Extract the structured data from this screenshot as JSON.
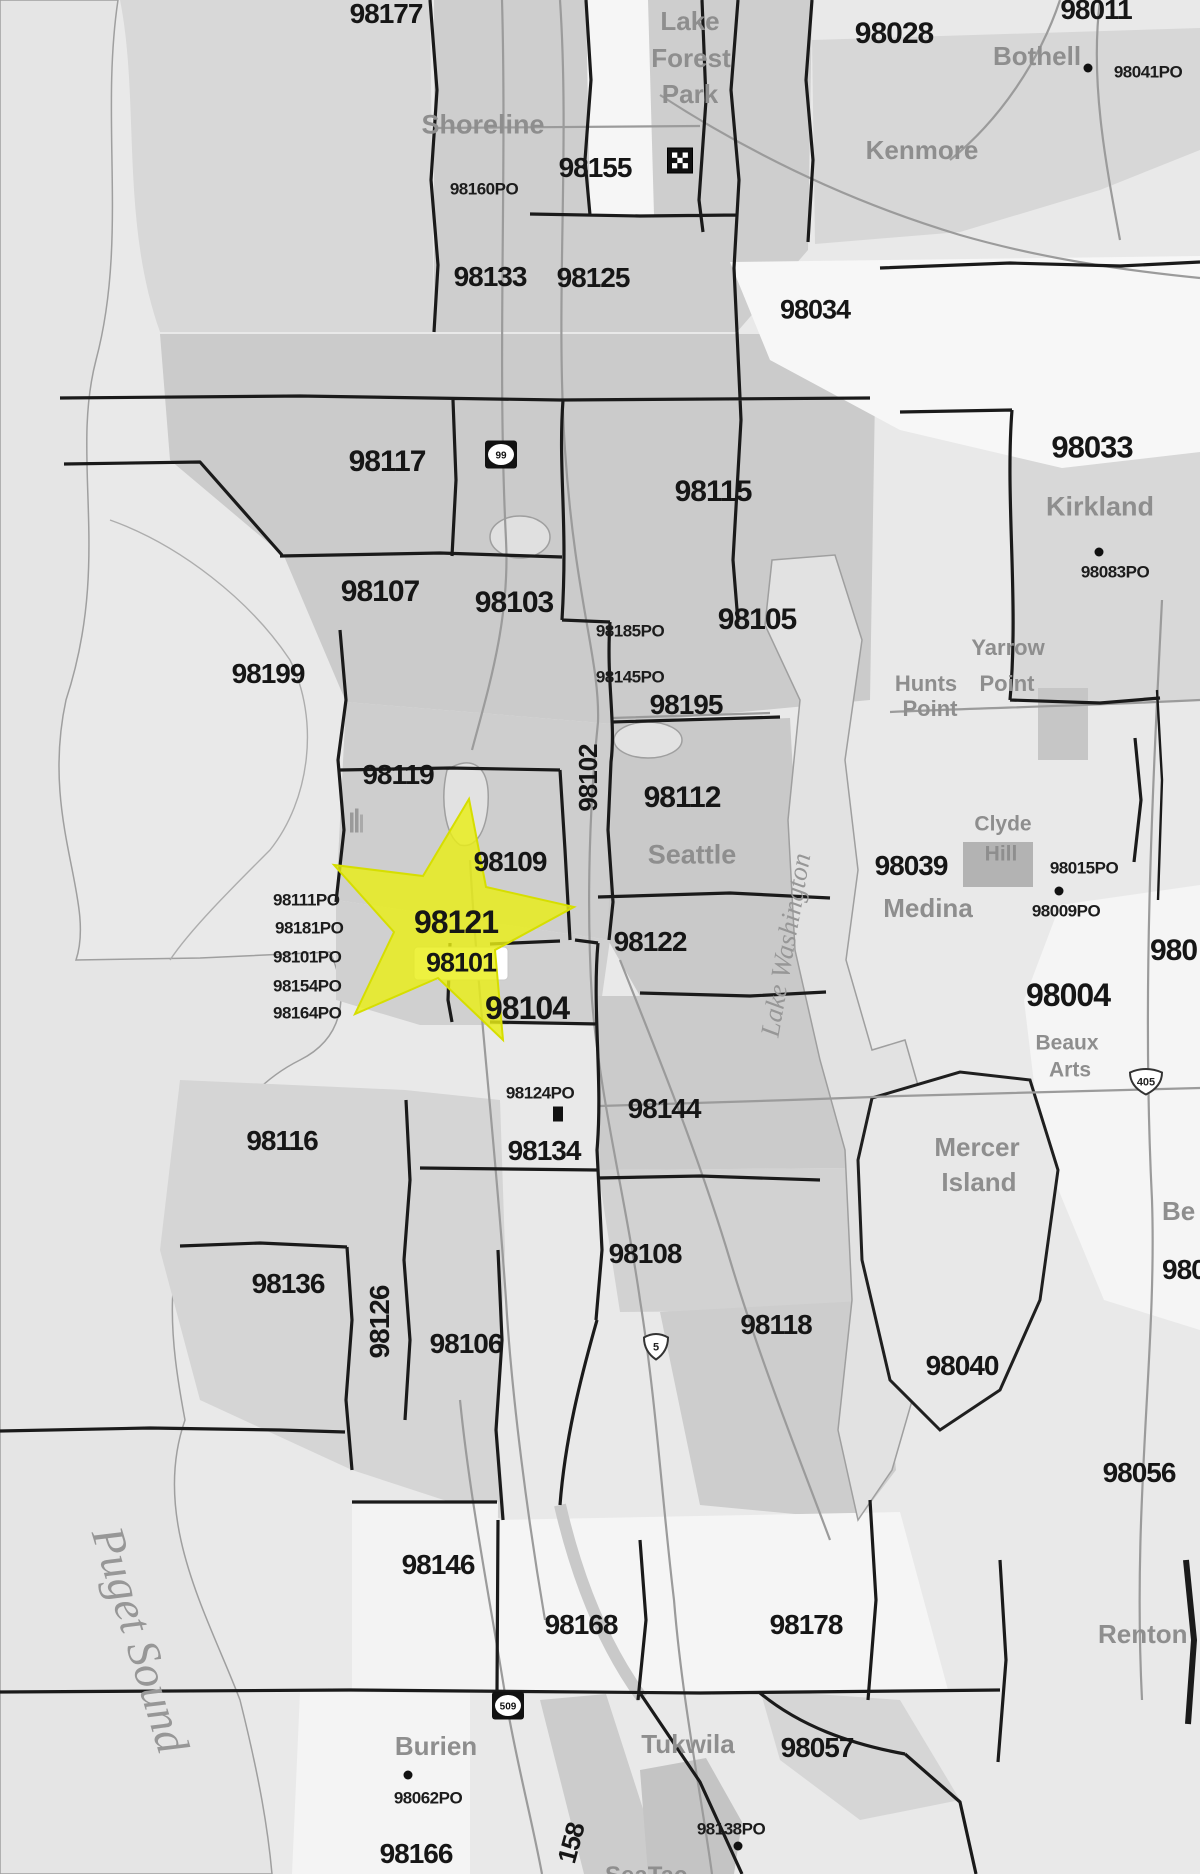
{
  "map": {
    "description": "Seattle area ZIP code map with highlighted star over downtown Seattle",
    "colors": {
      "land": "#e9e9e9",
      "land_dark": "#cbcbcb",
      "water": "#e4e4e4",
      "white_region": "#f6f6f6",
      "boundary": "#1a1a1a",
      "road": "#9b9b9b",
      "zip_text": "#161616",
      "city_text": "#8e8e8e",
      "water_text": "#979797",
      "highlight_star": "#e9ee16"
    },
    "highlight_star": {
      "cx": 447,
      "cy": 925,
      "note": "yellow star over 98121/98101"
    },
    "labels": [
      {
        "kind": "zip",
        "text": "98177",
        "x": 386,
        "y": 14,
        "size": 28
      },
      {
        "kind": "zip",
        "text": "98011",
        "x": 1096,
        "y": 10,
        "size": 28
      },
      {
        "kind": "zip",
        "text": "98028",
        "x": 894,
        "y": 34,
        "size": 30
      },
      {
        "kind": "zip",
        "text": "98155",
        "x": 595,
        "y": 168,
        "size": 28
      },
      {
        "kind": "zip",
        "text": "98133",
        "x": 490,
        "y": 277,
        "size": 28
      },
      {
        "kind": "zip",
        "text": "98125",
        "x": 593,
        "y": 278,
        "size": 28
      },
      {
        "kind": "zip",
        "text": "98034",
        "x": 815,
        "y": 310,
        "size": 27
      },
      {
        "kind": "zip",
        "text": "98117",
        "x": 387,
        "y": 462,
        "size": 30
      },
      {
        "kind": "zip",
        "text": "98115",
        "x": 713,
        "y": 492,
        "size": 30
      },
      {
        "kind": "zip",
        "text": "98033",
        "x": 1092,
        "y": 447,
        "size": 31
      },
      {
        "kind": "zip",
        "text": "98107",
        "x": 380,
        "y": 592,
        "size": 30
      },
      {
        "kind": "zip",
        "text": "98103",
        "x": 514,
        "y": 603,
        "size": 30
      },
      {
        "kind": "zip",
        "text": "98105",
        "x": 757,
        "y": 620,
        "size": 30
      },
      {
        "kind": "zip",
        "text": "98195",
        "x": 686,
        "y": 705,
        "size": 28
      },
      {
        "kind": "zip",
        "text": "98199",
        "x": 268,
        "y": 674,
        "size": 28
      },
      {
        "kind": "zip",
        "text": "98119",
        "x": 398,
        "y": 775,
        "size": 28
      },
      {
        "kind": "zip",
        "text": "98102",
        "x": 588,
        "y": 778,
        "size": 26,
        "rot": -90
      },
      {
        "kind": "zip",
        "text": "98112",
        "x": 682,
        "y": 798,
        "size": 30
      },
      {
        "kind": "zip",
        "text": "98109",
        "x": 510,
        "y": 862,
        "size": 28
      },
      {
        "kind": "zip",
        "text": "98121",
        "x": 456,
        "y": 922,
        "size": 32
      },
      {
        "kind": "zip",
        "text": "98101",
        "x": 461,
        "y": 963,
        "size": 27
      },
      {
        "kind": "zip",
        "text": "98122",
        "x": 650,
        "y": 942,
        "size": 28
      },
      {
        "kind": "zip",
        "text": "98104",
        "x": 527,
        "y": 1008,
        "size": 32
      },
      {
        "kind": "zip",
        "text": "98039",
        "x": 911,
        "y": 866,
        "size": 28
      },
      {
        "kind": "zip",
        "text": "98004",
        "x": 1068,
        "y": 995,
        "size": 32
      },
      {
        "kind": "zip",
        "text": "98144",
        "x": 664,
        "y": 1109,
        "size": 28
      },
      {
        "kind": "zip",
        "text": "98134",
        "x": 544,
        "y": 1151,
        "size": 28
      },
      {
        "kind": "zip",
        "text": "98116",
        "x": 282,
        "y": 1141,
        "size": 28
      },
      {
        "kind": "zip",
        "text": "98136",
        "x": 288,
        "y": 1284,
        "size": 28
      },
      {
        "kind": "zip",
        "text": "98126",
        "x": 380,
        "y": 1322,
        "size": 28,
        "rot": -90
      },
      {
        "kind": "zip",
        "text": "98106",
        "x": 466,
        "y": 1344,
        "size": 28
      },
      {
        "kind": "zip",
        "text": "98108",
        "x": 645,
        "y": 1254,
        "size": 28
      },
      {
        "kind": "zip",
        "text": "98118",
        "x": 776,
        "y": 1325,
        "size": 28
      },
      {
        "kind": "zip",
        "text": "98040",
        "x": 962,
        "y": 1366,
        "size": 28
      },
      {
        "kind": "zip",
        "text": "98056",
        "x": 1139,
        "y": 1473,
        "size": 28
      },
      {
        "kind": "zip",
        "text": "98146",
        "x": 438,
        "y": 1565,
        "size": 28
      },
      {
        "kind": "zip",
        "text": "98168",
        "x": 581,
        "y": 1625,
        "size": 28
      },
      {
        "kind": "zip",
        "text": "98178",
        "x": 806,
        "y": 1625,
        "size": 28
      },
      {
        "kind": "zip",
        "text": "98057",
        "x": 817,
        "y": 1748,
        "size": 28
      },
      {
        "kind": "zip",
        "text": "98166",
        "x": 416,
        "y": 1854,
        "size": 28
      },
      {
        "kind": "zip",
        "text": "158",
        "x": 571,
        "y": 1843,
        "size": 26,
        "rot": -75
      },
      {
        "kind": "zip",
        "text": "980",
        "x": 1150,
        "y": 951,
        "size": 30,
        "anchor": "left"
      },
      {
        "kind": "zip",
        "text": "980",
        "x": 1162,
        "y": 1270,
        "size": 28,
        "anchor": "left"
      },
      {
        "kind": "po",
        "text": "98160PO",
        "x": 484,
        "y": 189
      },
      {
        "kind": "po",
        "text": "98041PO",
        "x": 1148,
        "y": 72
      },
      {
        "kind": "po",
        "text": "98083PO",
        "x": 1115,
        "y": 572
      },
      {
        "kind": "po",
        "text": "98185PO",
        "x": 630,
        "y": 631
      },
      {
        "kind": "po",
        "text": "98145PO",
        "x": 630,
        "y": 677
      },
      {
        "kind": "po",
        "text": "98015PO",
        "x": 1084,
        "y": 868
      },
      {
        "kind": "po",
        "text": "98009PO",
        "x": 1066,
        "y": 911
      },
      {
        "kind": "po",
        "text": "98111PO",
        "x": 273,
        "y": 900,
        "anchor": "left"
      },
      {
        "kind": "po",
        "text": "98181PO",
        "x": 275,
        "y": 928,
        "anchor": "left"
      },
      {
        "kind": "po",
        "text": "98101PO",
        "x": 273,
        "y": 957,
        "anchor": "left"
      },
      {
        "kind": "po",
        "text": "98154PO",
        "x": 273,
        "y": 986,
        "anchor": "left"
      },
      {
        "kind": "po",
        "text": "98164PO",
        "x": 273,
        "y": 1013,
        "anchor": "left"
      },
      {
        "kind": "po",
        "text": "98124PO",
        "x": 540,
        "y": 1093
      },
      {
        "kind": "po",
        "text": "98062PO",
        "x": 428,
        "y": 1798
      },
      {
        "kind": "po",
        "text": "98138PO",
        "x": 731,
        "y": 1829
      },
      {
        "kind": "city",
        "text": "Lake",
        "x": 690,
        "y": 21,
        "size": 26
      },
      {
        "kind": "city",
        "text": "Forest",
        "x": 691,
        "y": 58,
        "size": 26
      },
      {
        "kind": "city",
        "text": "Park",
        "x": 690,
        "y": 94,
        "size": 26
      },
      {
        "kind": "city",
        "text": "Shoreline",
        "x": 483,
        "y": 125,
        "size": 27
      },
      {
        "kind": "city",
        "text": "Kenmore",
        "x": 922,
        "y": 150,
        "size": 26
      },
      {
        "kind": "city",
        "text": "Bothell",
        "x": 1037,
        "y": 56,
        "size": 26
      },
      {
        "kind": "city",
        "text": "Kirkland",
        "x": 1100,
        "y": 507,
        "size": 27
      },
      {
        "kind": "city",
        "text": "Yarrow",
        "x": 1008,
        "y": 648,
        "size": 22
      },
      {
        "kind": "city",
        "text": "Hunts",
        "x": 926,
        "y": 684,
        "size": 22
      },
      {
        "kind": "city",
        "text": "Point",
        "x": 1007,
        "y": 684,
        "size": 22
      },
      {
        "kind": "city",
        "text": "Point",
        "x": 930,
        "y": 709,
        "size": 22
      },
      {
        "kind": "city",
        "text": "Clyde",
        "x": 1003,
        "y": 824,
        "size": 21
      },
      {
        "kind": "city",
        "text": "Hill",
        "x": 1001,
        "y": 854,
        "size": 21
      },
      {
        "kind": "city",
        "text": "Medina",
        "x": 928,
        "y": 908,
        "size": 26
      },
      {
        "kind": "city",
        "text": "Seattle",
        "x": 692,
        "y": 855,
        "size": 27
      },
      {
        "kind": "city",
        "text": "Mercer",
        "x": 977,
        "y": 1147,
        "size": 26
      },
      {
        "kind": "city",
        "text": "Island",
        "x": 979,
        "y": 1182,
        "size": 26
      },
      {
        "kind": "city",
        "text": "Beaux",
        "x": 1067,
        "y": 1043,
        "size": 21
      },
      {
        "kind": "city",
        "text": "Arts",
        "x": 1070,
        "y": 1070,
        "size": 21
      },
      {
        "kind": "city",
        "text": "Burien",
        "x": 436,
        "y": 1746,
        "size": 26
      },
      {
        "kind": "city",
        "text": "Tukwila",
        "x": 688,
        "y": 1744,
        "size": 26
      },
      {
        "kind": "city",
        "text": "Renton",
        "x": 1098,
        "y": 1634,
        "size": 26,
        "anchor": "left"
      },
      {
        "kind": "city",
        "text": "Be",
        "x": 1162,
        "y": 1211,
        "size": 26,
        "anchor": "left"
      },
      {
        "kind": "city",
        "text": "SeaTac",
        "x": 605,
        "y": 1876,
        "size": 24,
        "anchor": "left"
      },
      {
        "kind": "water",
        "text": "Puget Sound",
        "x": 140,
        "y": 1640,
        "size": 46,
        "rot": 73
      },
      {
        "kind": "water",
        "text": "Lake Washington",
        "x": 786,
        "y": 945,
        "size": 27,
        "rot": -80
      }
    ],
    "shields": [
      {
        "kind": "checkered",
        "label": "",
        "x": 680,
        "y": 163
      },
      {
        "kind": "sr",
        "label": "99",
        "x": 501,
        "y": 457
      },
      {
        "kind": "interstate",
        "label": "5",
        "x": 656,
        "y": 1348
      },
      {
        "kind": "interstate",
        "label": "405",
        "x": 1146,
        "y": 1083
      },
      {
        "kind": "sr",
        "label": "509",
        "x": 508,
        "y": 1708
      },
      {
        "kind": "building",
        "label": "",
        "x": 356,
        "y": 824
      }
    ],
    "markers": [
      {
        "shape": "dot",
        "x": 1088,
        "y": 68
      },
      {
        "shape": "dot",
        "x": 1099,
        "y": 552
      },
      {
        "shape": "dot",
        "x": 1059,
        "y": 891
      },
      {
        "shape": "square",
        "x": 558,
        "y": 1114
      },
      {
        "shape": "dot",
        "x": 408,
        "y": 1775
      },
      {
        "shape": "dot",
        "x": 738,
        "y": 1846
      }
    ]
  }
}
